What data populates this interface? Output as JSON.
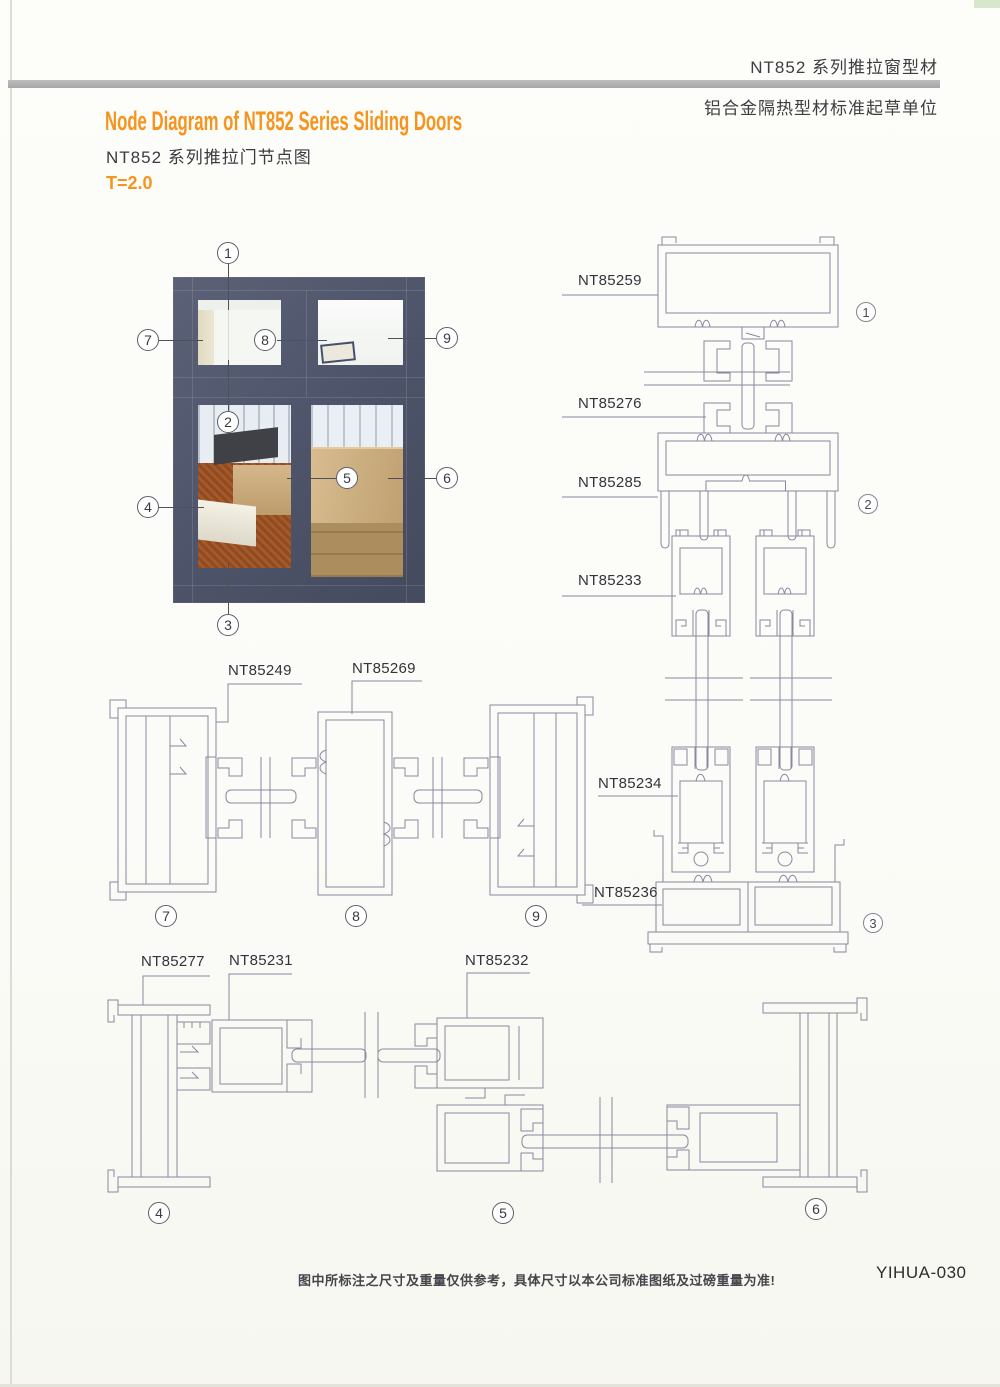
{
  "header": {
    "product_line": "NT852 系列推拉窗型材",
    "org": "铝合金隔热型材标准起草单位"
  },
  "title": {
    "en": "Node Diagram of NT852 Series Sliding Doors",
    "zh": "NT852 系列推拉门节点图",
    "thickness": "T=2.0"
  },
  "parts": {
    "p59": "NT85259",
    "p76": "NT85276",
    "p85": "NT85285",
    "p33": "NT85233",
    "p34": "NT85234",
    "p36": "NT85236",
    "p49": "NT85249",
    "p69": "NT85269",
    "p77": "NT85277",
    "p31": "NT85231",
    "p32": "NT85232"
  },
  "nums": {
    "n1": "1",
    "n2": "2",
    "n3": "3",
    "n4": "4",
    "n5": "5",
    "n6": "6",
    "n7": "7",
    "n8": "8",
    "n9": "9"
  },
  "footer": {
    "note": "图中所标注之尺寸及重量仅供参考，具体尺寸以本公司标准图纸及过磅重量为准!",
    "code": "YIHUA-030"
  },
  "colors": {
    "accent_orange": "#f6941e",
    "window_frame": "#4f5569",
    "drawing_line": "#8e86a0",
    "header_bar": "#b0b0b0"
  }
}
